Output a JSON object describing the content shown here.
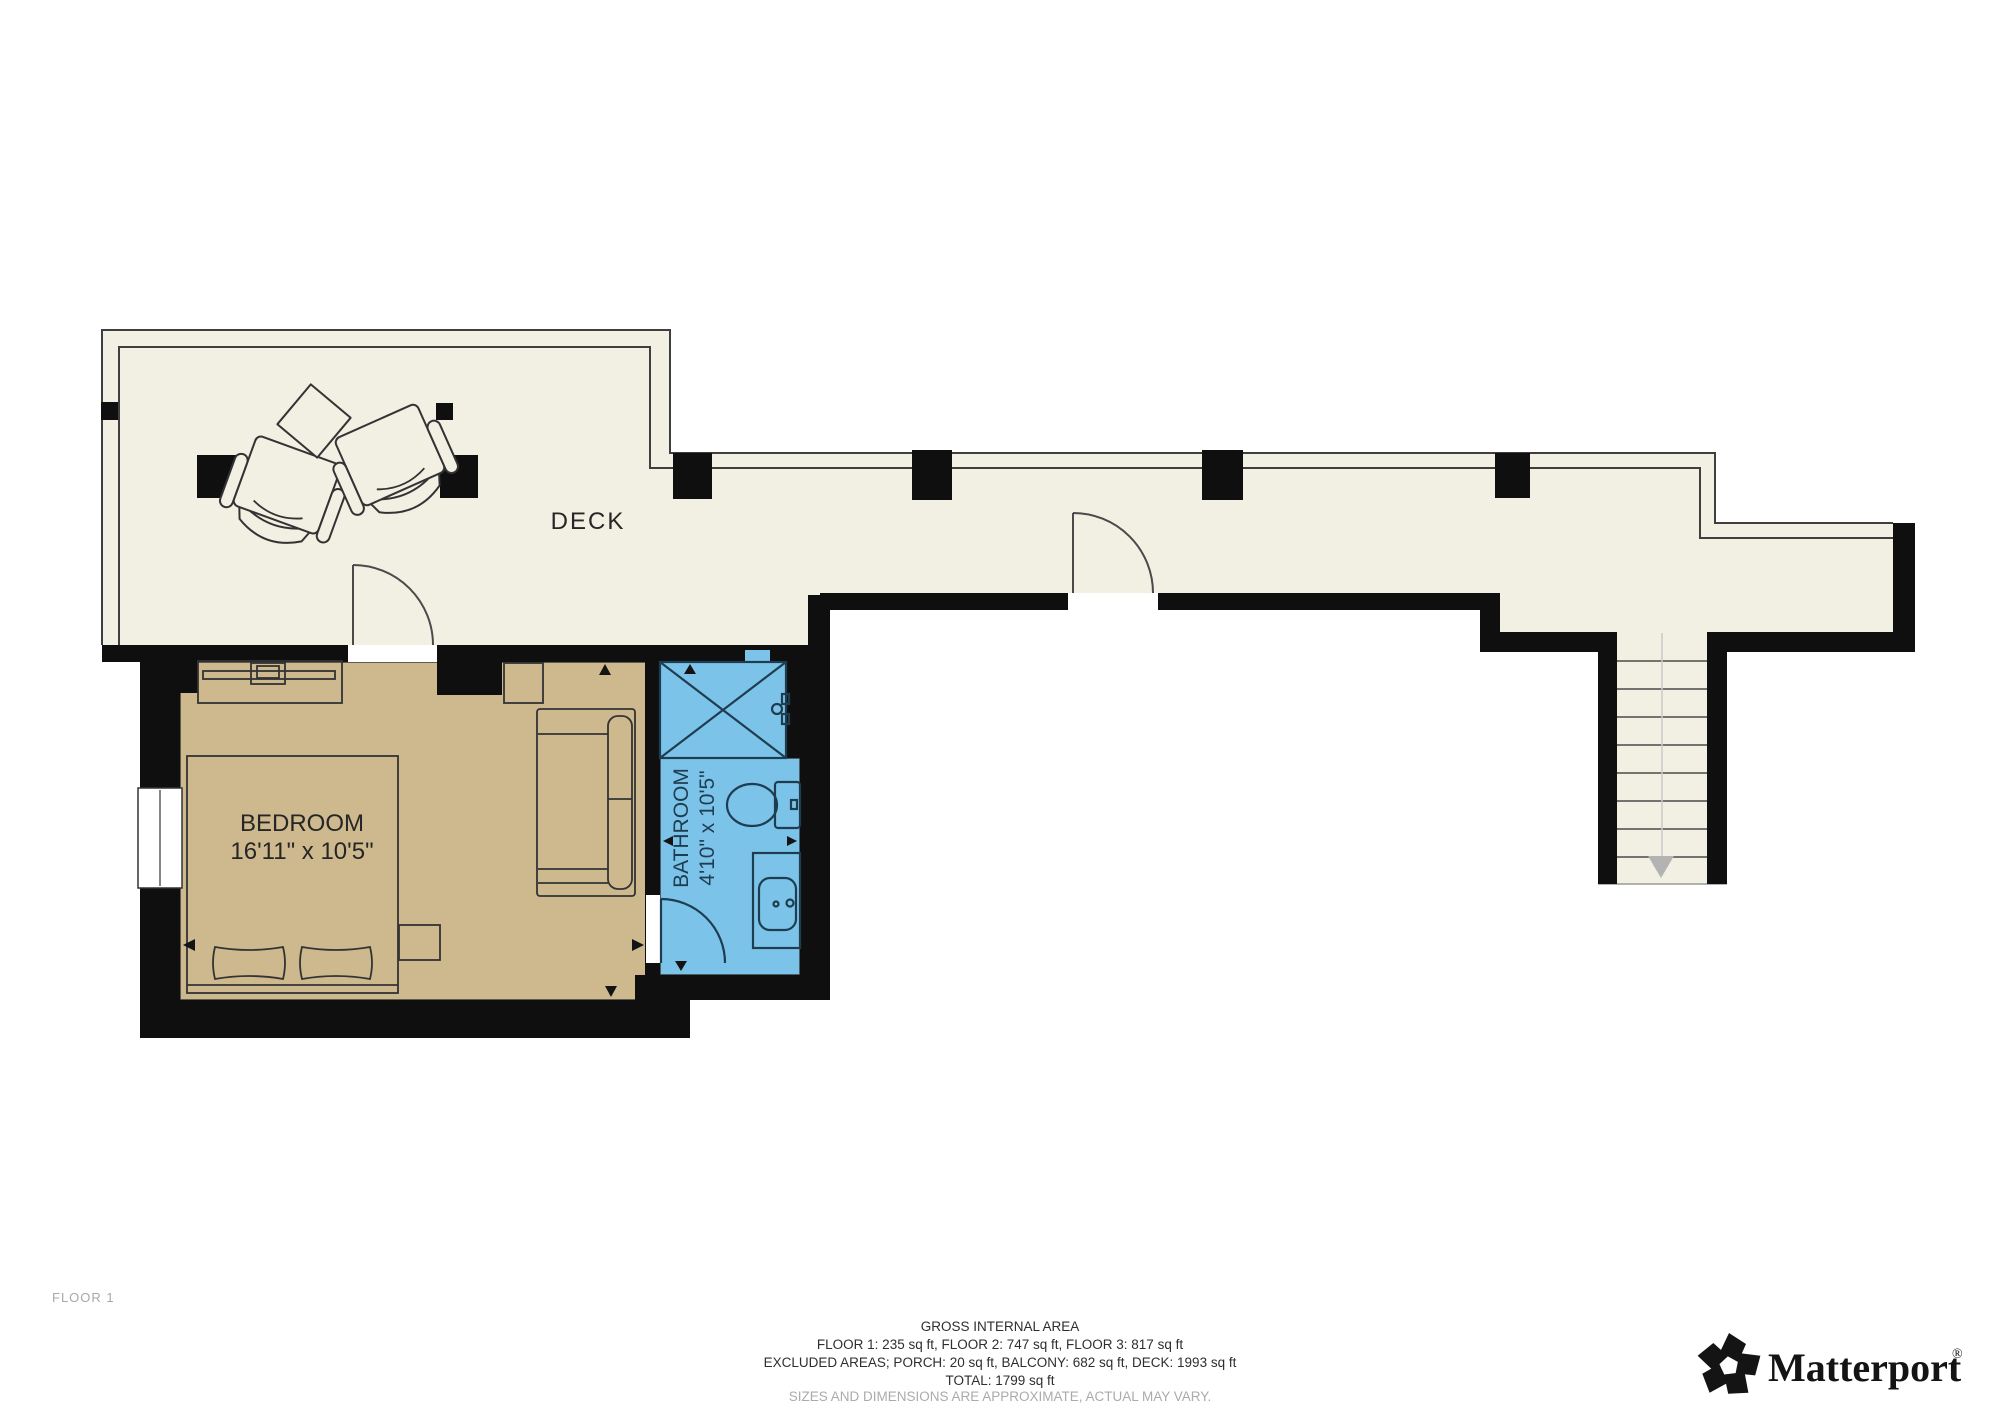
{
  "floor_label": "FLOOR 1",
  "rooms": {
    "deck": {
      "label": "DECK"
    },
    "bedroom": {
      "label": "BEDROOM",
      "dimensions": "16'11\" x 10'5\""
    },
    "bathroom": {
      "label": "BATHROOM",
      "dimensions": "4'10\" x 10'5\""
    }
  },
  "footer": {
    "heading": "GROSS INTERNAL AREA",
    "floors": "FLOOR 1: 235 sq ft, FLOOR 2: 747 sq ft, FLOOR 3: 817 sq ft",
    "excluded": "EXCLUDED AREAS; PORCH: 20 sq ft, BALCONY: 682 sq ft, DECK: 1993 sq ft",
    "total": "TOTAL: 1799 sq ft",
    "disclaimer": "SIZES AND DIMENSIONS ARE APPROXIMATE, ACTUAL MAY VARY."
  },
  "brand": {
    "name": "Matterport",
    "registered": "®"
  },
  "colors": {
    "deck_fill": "#F2EFE3",
    "bedroom_fill": "#CDB98D",
    "bathroom_fill": "#7CC3EA",
    "wall": "#0F0F0F",
    "outline": "#3F3F3F",
    "label": "#262626",
    "bathroom_label": "#1E3D50",
    "muted": "#ABABAB"
  }
}
